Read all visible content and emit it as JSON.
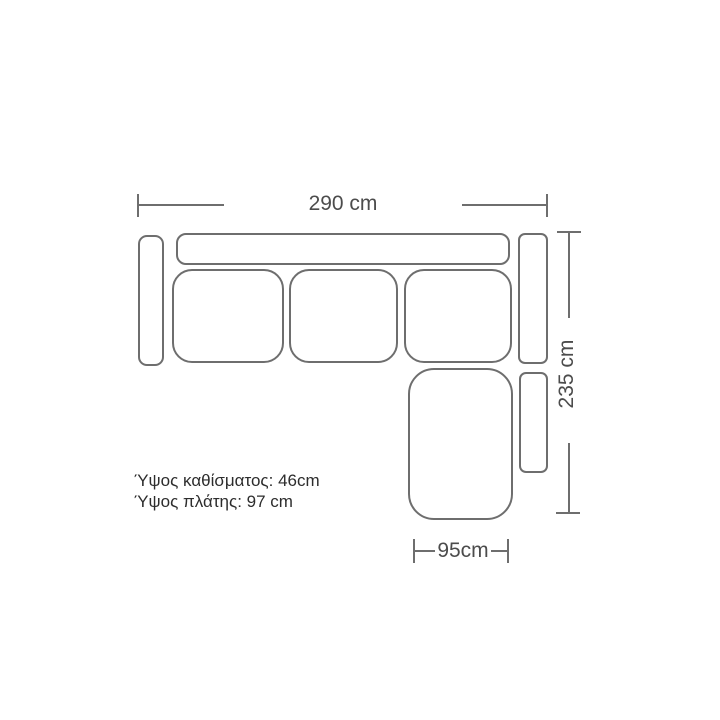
{
  "dimensions": {
    "width_label": "290 cm",
    "depth_label": "235 cm",
    "chaise_width_label": "95cm"
  },
  "notes": {
    "seat_height": "Ύψος καθίσματος: 46cm",
    "back_height": "Ύψος πλάτης: 97 cm"
  },
  "colors": {
    "line": "#6e6e6e",
    "dimension_text": "#4c4c4c",
    "note_text": "#2d2d2d",
    "background": "#ffffff"
  },
  "parts": {
    "left_armrest": "left-armrest",
    "backrest": "backrest",
    "seat_cushion_1": "seat-cushion-1",
    "seat_cushion_2": "seat-cushion-2",
    "seat_cushion_3": "seat-cushion-3",
    "right_armrest": "right-armrest",
    "chaise": "chaise",
    "chaise_armrest": "chaise-armrest"
  }
}
